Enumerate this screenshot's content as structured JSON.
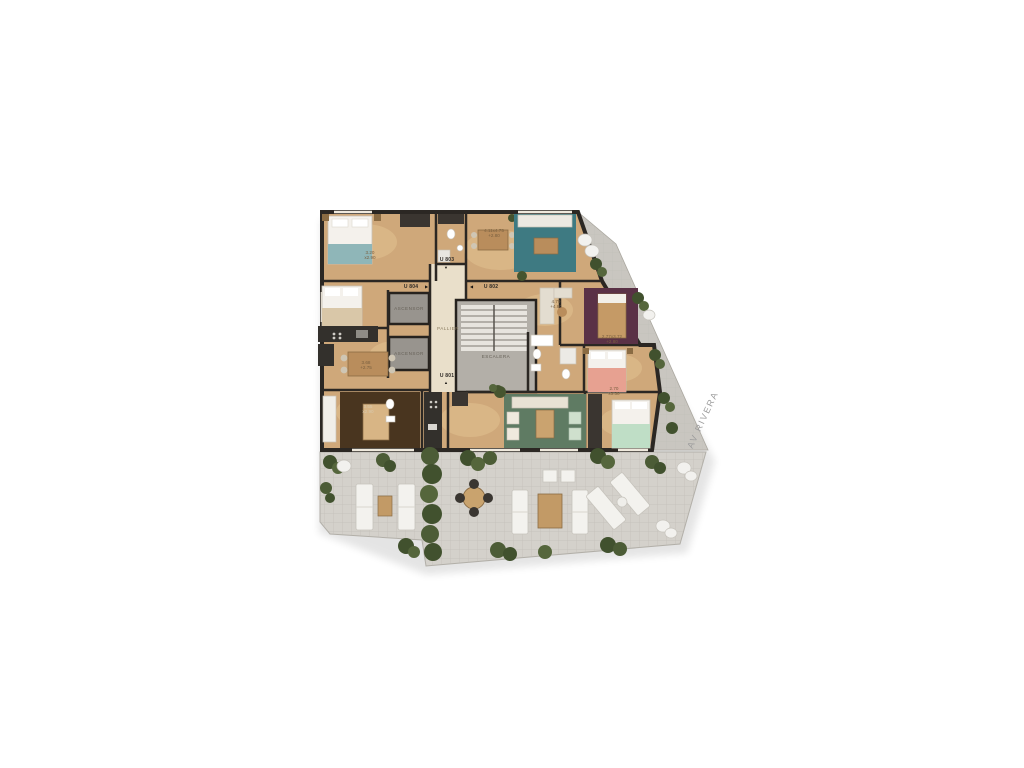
{
  "plan": {
    "core": {
      "elevator_1": "ASCENSOR",
      "elevator_2": "ASCENSOR",
      "hall": "PALLIER",
      "stairs": "ESCALERA"
    },
    "units": {
      "u803": "U 803",
      "u804": "U 804",
      "u802": "U 802",
      "u801": "U 801"
    },
    "door_markers": {
      "u803": "▼",
      "u804": "▶",
      "u802": "◀",
      "u801": "▲"
    },
    "street": "AV RIVERA",
    "dims": {
      "bedroom_top_left": [
        "3.20",
        "x2.90"
      ],
      "living_top": [
        "4.11x4.75",
        "+2.80"
      ],
      "living_right": [
        "4.79",
        "+4.80"
      ],
      "bedroom_right": [
        "2.77x3.72",
        "+2.80"
      ],
      "dining_left": [
        "3.68",
        "+2.75"
      ],
      "room_bottom_left": [
        "3.55",
        "x2.90"
      ],
      "bedroom_bottom_right": [
        "2.70",
        "x3.30"
      ]
    },
    "colors": {
      "floor_wood": "#cfa87a",
      "walls": "#2b2723",
      "terrace": "#d4d1cb",
      "balcony": "#c9c6c0",
      "rug_teal": "#3e7a82",
      "rug_maroon": "#5a3146",
      "rug_green": "#5f7b63",
      "rug_brown": "#49351f",
      "bed_salmon": "#e7a191",
      "bed_mint": "#bfdec6",
      "bed_teal": "#8fb6b8",
      "plants": "#4c5c36",
      "furniture_white": "#f3f2ee",
      "wood_furniture": "#c29a66",
      "hall_floor": "#e9dfca"
    }
  }
}
